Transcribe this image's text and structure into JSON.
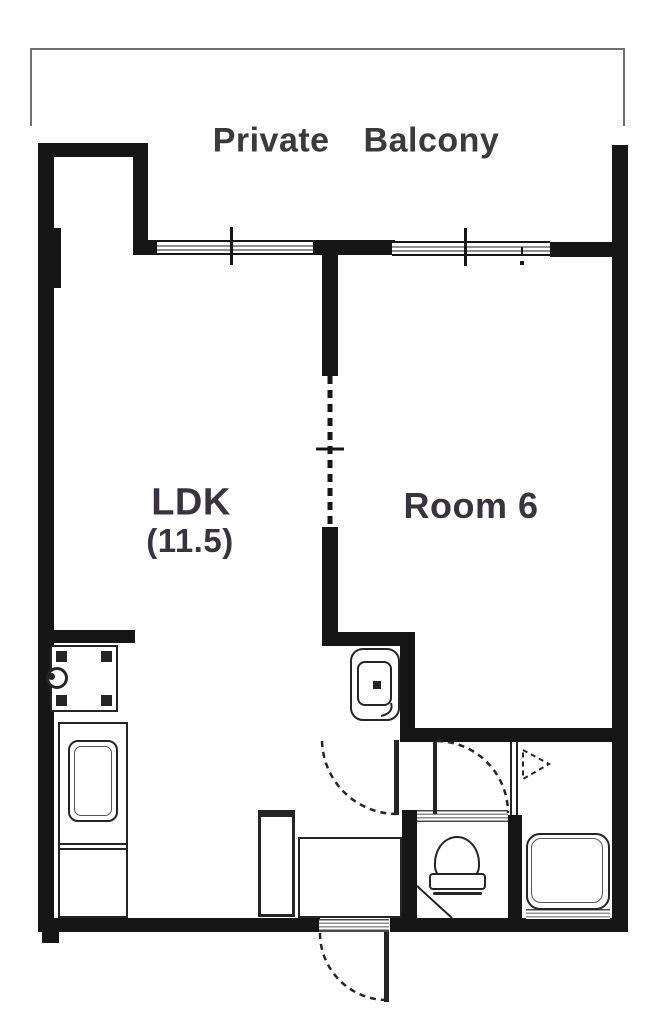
{
  "theme": {
    "wall": "#161616",
    "line": "#252525",
    "hatch": "#8f8f8f",
    "text": "#38343d",
    "balcony-line": "#6f6f6f",
    "bg": "#ffffff"
  },
  "labels": {
    "balcony": "Private Balcony",
    "ldk": "LDK",
    "ldk_size": "(11.5)",
    "room6": "Room 6"
  },
  "rooms": [
    {
      "id": "balcony",
      "label": "Private Balcony"
    },
    {
      "id": "ldk",
      "label": "LDK",
      "size_tatami": "(11.5)"
    },
    {
      "id": "room6",
      "label": "Room 6"
    }
  ],
  "fixtures": [
    "washing-machine-pan",
    "kitchen-counter",
    "kitchen-sink",
    "washbasin",
    "toilet",
    "bathtub",
    "shoe-cabinet",
    "entrance-step",
    "sliding-window-left",
    "sliding-window-right",
    "sliding-partition",
    "hinged-door-ldk",
    "hinged-door-toilet",
    "hinged-door-entrance",
    "folding-bath-door"
  ]
}
